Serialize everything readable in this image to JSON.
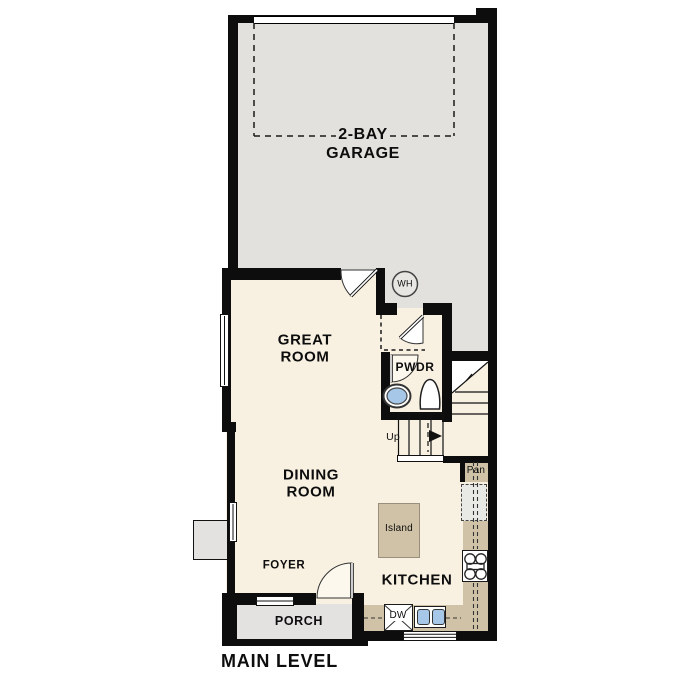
{
  "title": "MAIN LEVEL",
  "rooms": {
    "garage": {
      "line1": "2-BAY",
      "line2": "GARAGE"
    },
    "great_room": {
      "line1": "GREAT",
      "line2": "ROOM"
    },
    "dining_room": {
      "line1": "DINING",
      "line2": "ROOM"
    },
    "kitchen": {
      "label": "KITCHEN"
    },
    "powder": {
      "label": "PWDR"
    },
    "foyer": {
      "label": "FOYER"
    },
    "porch": {
      "label": "PORCH"
    }
  },
  "fixtures": {
    "water_heater": "WH",
    "island": "Island",
    "pantry": "Pan",
    "dishwasher": "DW",
    "stairs_direction": "Up"
  },
  "colors": {
    "wall": "#0d0d0d",
    "garage_floor": "#e2e1de",
    "living_floor": "#f8f1e2",
    "counter": "#cfc2a7",
    "porch_floor": "#e3e2e0",
    "appliance_blue": "#a6c7e8",
    "line": "#1a1a1a"
  }
}
